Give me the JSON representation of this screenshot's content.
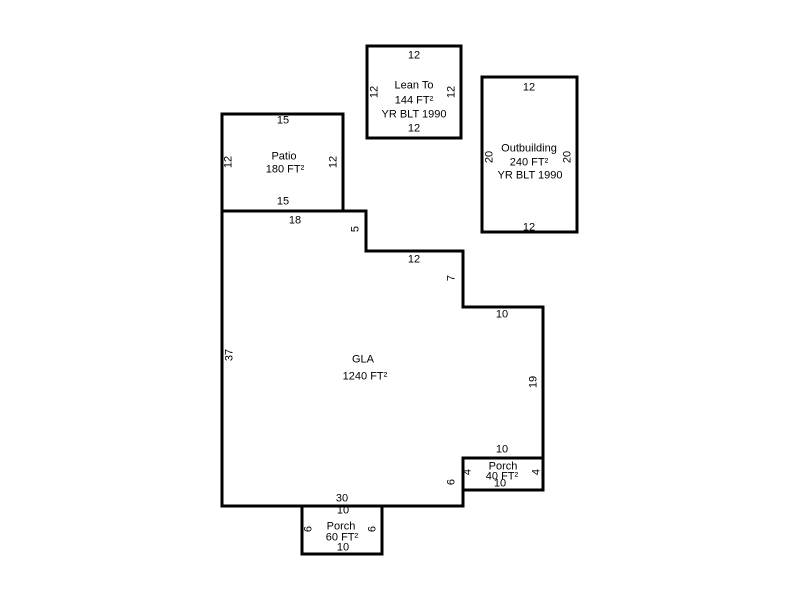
{
  "sketch_title": "Property Sketch",
  "colors": {
    "background": "#ffffff",
    "line": "#000000",
    "text": "#000000"
  },
  "structures": {
    "lean_to": {
      "label": "Lean To",
      "area": "144 FT²",
      "year_built": "YR BLT 1990",
      "dim_top": "12",
      "dim_bottom": "12",
      "dim_left": "12",
      "dim_right": "12"
    },
    "outbuilding": {
      "label": "Outbuilding",
      "area": "240 FT²",
      "year_built": "YR BLT 1990",
      "dim_top": "12",
      "dim_bottom": "12",
      "dim_left": "20",
      "dim_right": "20"
    },
    "patio": {
      "label": "Patio",
      "area": "180 FT²",
      "dim_top": "15",
      "dim_bottom": "15",
      "dim_left": "12",
      "dim_right": "12"
    },
    "gla": {
      "label": "GLA",
      "area": "1240 FT²",
      "dim_left_wall": "37",
      "dim_top_edge": "18",
      "dim_step_down_1": "5",
      "dim_step_right_1": "12",
      "dim_step_down_2": "7",
      "dim_step_right_2": "10",
      "dim_right_wall": "19",
      "dim_above_porch": "10",
      "dim_lower_right_wall": "6",
      "dim_bottom_edge": "30"
    },
    "porch_right": {
      "label": "Porch",
      "area": "40 FT²",
      "dim_bottom": "10",
      "dim_left": "4",
      "dim_right": "4"
    },
    "porch_bottom": {
      "label": "Porch",
      "area": "60 FT²",
      "dim_top": "10",
      "dim_bottom": "10",
      "dim_left": "6",
      "dim_right": "6"
    }
  }
}
